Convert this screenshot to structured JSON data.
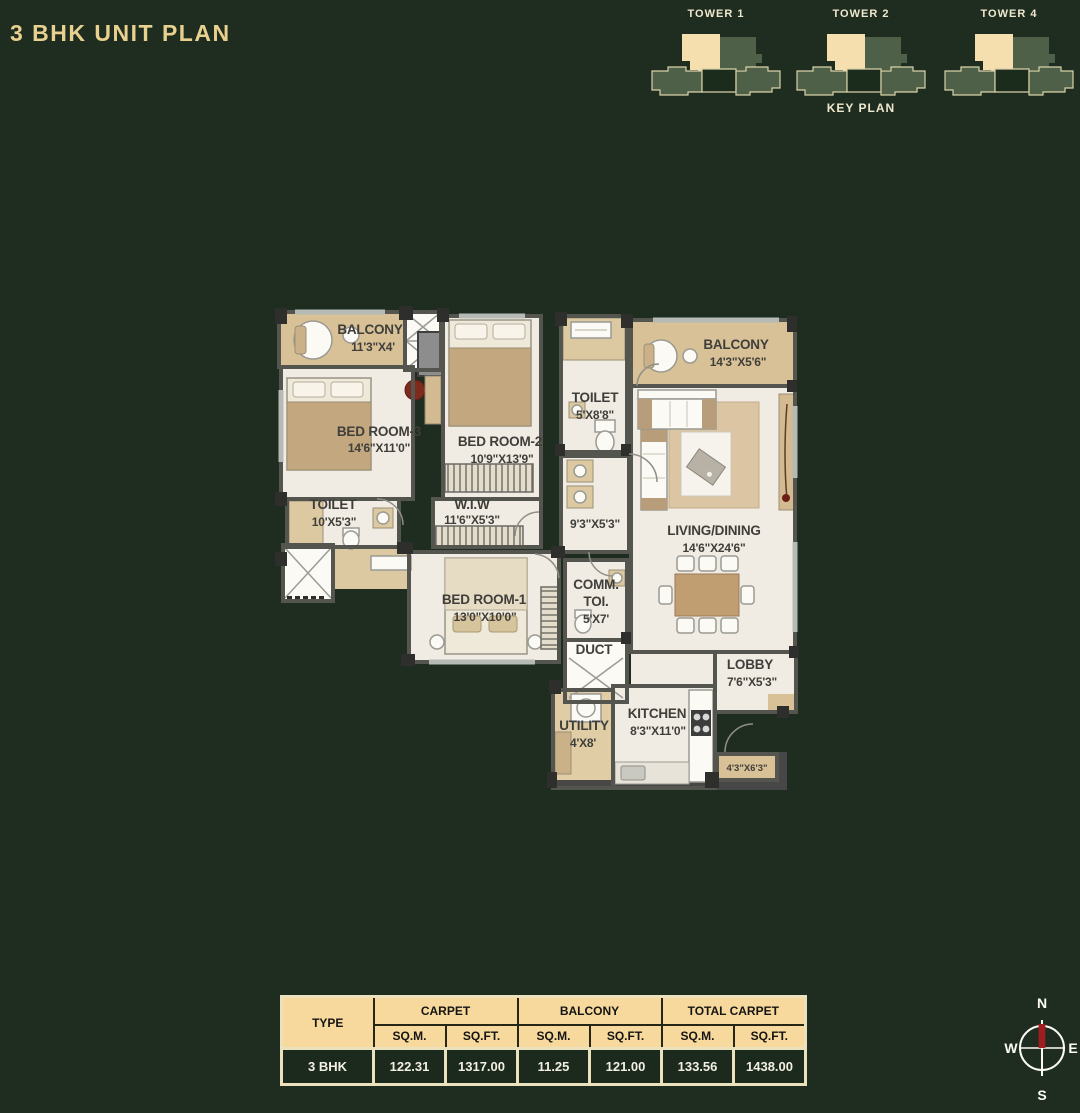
{
  "header": {
    "title": "3 BHK UNIT PLAN",
    "accent_color": "#e8d08e"
  },
  "key_plan": {
    "label": "KEY PLAN",
    "towers": [
      {
        "name": "TOWER 1"
      },
      {
        "name": "TOWER 2"
      },
      {
        "name": "TOWER 4"
      }
    ],
    "colors": {
      "highlight_unit": "#f6dfae",
      "building": "#4f6049",
      "shadow": "#1b2b1c",
      "outline": "#d9d1a8"
    }
  },
  "plan": {
    "rooms": [
      {
        "name": "BALCONY",
        "dims": "11'3\"X4'"
      },
      {
        "name": "BED ROOM-3",
        "dims": "14'6\"X11'0\""
      },
      {
        "name": "BED ROOM-2",
        "dims": "10'9\"X13'9\""
      },
      {
        "name": "TOILET",
        "dims": "5'X8'8\""
      },
      {
        "name": "BALCONY",
        "dims": "14'3\"X5'6\""
      },
      {
        "name": "TOILET",
        "dims": "10'X5'3\""
      },
      {
        "name": "W.I.W",
        "dims": "11'6\"X5'3\""
      },
      {
        "name": "",
        "dims": "9'3\"X5'3\""
      },
      {
        "name": "LIVING/DINING",
        "dims": "14'6\"X24'6\""
      },
      {
        "name": "BED ROOM-1",
        "dims": "13'0\"X10'0\""
      },
      {
        "name": "COMM.",
        "line2": "TOI.",
        "dims": "5'X7'"
      },
      {
        "name": "DUCT",
        "dims": ""
      },
      {
        "name": "LOBBY",
        "dims": "7'6\"X5'3\""
      },
      {
        "name": "UTILITY",
        "dims": "4'X8'"
      },
      {
        "name": "KITCHEN",
        "dims": "8'3\"X11'0\""
      },
      {
        "name": "",
        "dims": "4'3\"X6'3\""
      }
    ]
  },
  "table": {
    "type_label": "TYPE",
    "groups": [
      "CARPET",
      "BALCONY",
      "TOTAL CARPET"
    ],
    "units": [
      "SQ.M.",
      "SQ.FT.",
      "SQ.M.",
      "SQ.FT.",
      "SQ.M.",
      "SQ.FT."
    ],
    "rows": [
      {
        "type": "3 BHK",
        "values": [
          "122.31",
          "1317.00",
          "11.25",
          "121.00",
          "133.56",
          "1438.00"
        ]
      }
    ]
  },
  "compass": {
    "n": "N",
    "s": "S",
    "e": "E",
    "w": "W",
    "needle_color": "#9e1d20"
  }
}
